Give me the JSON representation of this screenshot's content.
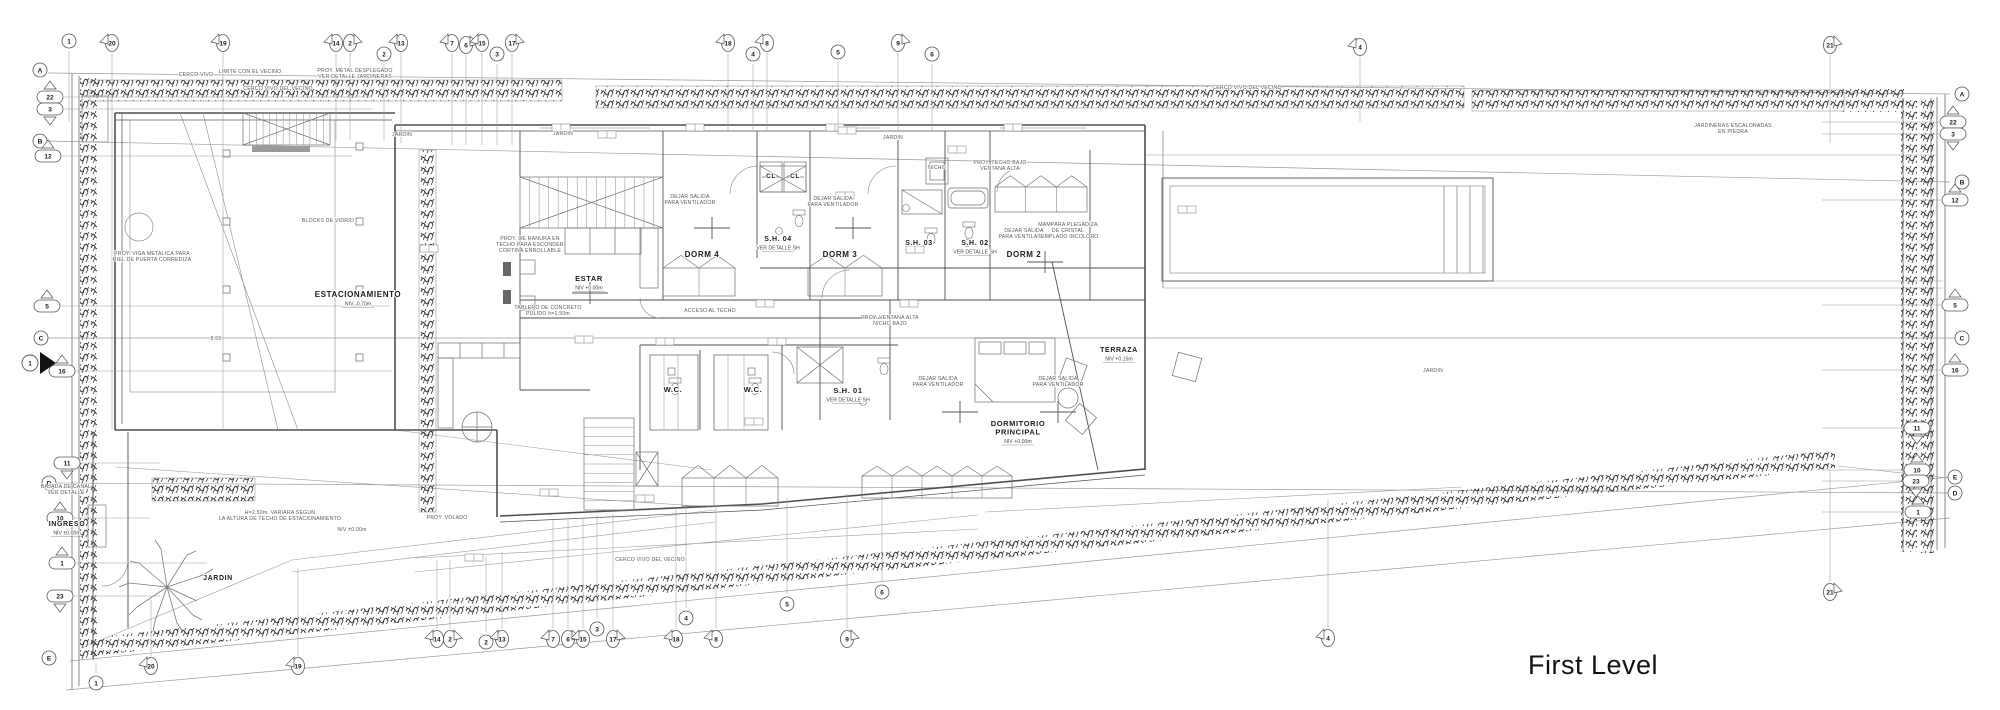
{
  "caption": {
    "text": "First Level"
  },
  "colors": {
    "line": "#9a9a9a",
    "wall": "#4f4f4f",
    "bubble_stroke": "#555555",
    "text": "#1c1c1c",
    "note": "#5a5a5a",
    "vegetation": "#333333",
    "background": "#ffffff"
  },
  "grid": {
    "top": [
      {
        "label": "1",
        "x": 69,
        "y": 41,
        "shape": "circle",
        "lead": 122
      },
      {
        "label": "20",
        "x": 112,
        "y": 43,
        "shape": "flag-left",
        "lead": 430
      },
      {
        "label": "19",
        "x": 223,
        "y": 43,
        "shape": "flag-left",
        "lead": 430
      },
      {
        "label": "14",
        "x": 336,
        "y": 43,
        "shape": "flag-left",
        "lead": 140
      },
      {
        "label": "2",
        "x": 350,
        "y": 43,
        "shape": "flag-right",
        "lead": 140
      },
      {
        "label": "2",
        "x": 384,
        "y": 54,
        "shape": "circle",
        "lead": 140
      },
      {
        "label": "13",
        "x": 401,
        "y": 43,
        "shape": "flag-left",
        "lead": 143
      },
      {
        "label": "7",
        "x": 452,
        "y": 43,
        "shape": "flag-left",
        "lead": 145
      },
      {
        "label": "6",
        "x": 466,
        "y": 45,
        "shape": "flag-right",
        "lead": 145
      },
      {
        "label": "15",
        "x": 482,
        "y": 43,
        "shape": "flag-left",
        "lead": 145
      },
      {
        "label": "3",
        "x": 497,
        "y": 54,
        "shape": "circle",
        "lead": 145
      },
      {
        "label": "17",
        "x": 512,
        "y": 43,
        "shape": "flag-right",
        "lead": 145
      },
      {
        "label": "18",
        "x": 728,
        "y": 43,
        "shape": "flag-left",
        "lead": 131
      },
      {
        "label": "4",
        "x": 753,
        "y": 54,
        "shape": "circle",
        "lead": 131
      },
      {
        "label": "8",
        "x": 767,
        "y": 43,
        "shape": "flag-left",
        "lead": 131
      },
      {
        "label": "5",
        "x": 838,
        "y": 52,
        "shape": "circle",
        "lead": 131
      },
      {
        "label": "9",
        "x": 898,
        "y": 43,
        "shape": "flag-right",
        "lead": 131
      },
      {
        "label": "6",
        "x": 932,
        "y": 54,
        "shape": "circle",
        "lead": 131
      },
      {
        "label": "4",
        "x": 1360,
        "y": 47,
        "shape": "flag-left",
        "lead": 122
      },
      {
        "label": "21",
        "x": 1830,
        "y": 45,
        "shape": "flag-right",
        "lead": 143
      }
    ],
    "bottom": [
      {
        "label": "1",
        "x": 96,
        "y": 683,
        "shape": "circle",
        "lead": 663
      },
      {
        "label": "20",
        "x": 151,
        "y": 666,
        "shape": "flag-left",
        "lead": 600
      },
      {
        "label": "19",
        "x": 298,
        "y": 666,
        "shape": "flag-left",
        "lead": 568
      },
      {
        "label": "14",
        "x": 437,
        "y": 639,
        "shape": "flag-left",
        "lead": 560
      },
      {
        "label": "2",
        "x": 450,
        "y": 639,
        "shape": "flag-right",
        "lead": 560
      },
      {
        "label": "2",
        "x": 486,
        "y": 642,
        "shape": "circle",
        "lead": 556
      },
      {
        "label": "13",
        "x": 502,
        "y": 639,
        "shape": "flag-left",
        "lead": 552
      },
      {
        "label": "7",
        "x": 553,
        "y": 639,
        "shape": "flag-left",
        "lead": 520
      },
      {
        "label": "6",
        "x": 568,
        "y": 639,
        "shape": "flag-right",
        "lead": 520
      },
      {
        "label": "15",
        "x": 583,
        "y": 639,
        "shape": "flag-left",
        "lead": 518
      },
      {
        "label": "3",
        "x": 597,
        "y": 629,
        "shape": "circle",
        "lead": 515
      },
      {
        "label": "17",
        "x": 613,
        "y": 639,
        "shape": "flag-right",
        "lead": 514
      },
      {
        "label": "18",
        "x": 676,
        "y": 639,
        "shape": "flag-left",
        "lead": 508
      },
      {
        "label": "4",
        "x": 686,
        "y": 618,
        "shape": "circle",
        "lead": 506
      },
      {
        "label": "8",
        "x": 716,
        "y": 639,
        "shape": "flag-left",
        "lead": 505
      },
      {
        "label": "5",
        "x": 787,
        "y": 604,
        "shape": "circle",
        "lead": 498
      },
      {
        "label": "9",
        "x": 847,
        "y": 639,
        "shape": "flag-right",
        "lead": 494
      },
      {
        "label": "6",
        "x": 882,
        "y": 592,
        "shape": "circle",
        "lead": 490
      },
      {
        "label": "4",
        "x": 1328,
        "y": 638,
        "shape": "flag-left",
        "lead": 500
      },
      {
        "label": "21",
        "x": 1830,
        "y": 592,
        "shape": "flag-right",
        "lead": 470
      }
    ],
    "left": [
      {
        "label": "A",
        "x": 40,
        "y": 70,
        "shape": "circle"
      },
      {
        "label": "22",
        "x": 50,
        "y": 97,
        "shape": "tri-up",
        "lead": 372
      },
      {
        "label": "3",
        "x": 50,
        "y": 109,
        "shape": "tri-down",
        "lead": 372
      },
      {
        "label": "B",
        "x": 40,
        "y": 141,
        "shape": "circle"
      },
      {
        "label": "12",
        "x": 48,
        "y": 156,
        "shape": "tri-up",
        "lead": 352
      },
      {
        "label": "5",
        "x": 47,
        "y": 306,
        "shape": "tri-up",
        "lead": 390
      },
      {
        "label": "C",
        "x": 41,
        "y": 338,
        "shape": "circle"
      },
      {
        "label": "1",
        "x": 30,
        "y": 363,
        "shape": "entry"
      },
      {
        "label": "16",
        "x": 62,
        "y": 371,
        "shape": "tri-up",
        "lead": 392
      },
      {
        "label": "11",
        "x": 67,
        "y": 463,
        "shape": "tri-down",
        "lead": 160
      },
      {
        "label": "D",
        "x": 49,
        "y": 483,
        "shape": "circle"
      },
      {
        "label": "10",
        "x": 60,
        "y": 518,
        "shape": "tri-up",
        "lead": 150
      },
      {
        "label": "1",
        "x": 62,
        "y": 563,
        "shape": "tri-up",
        "lead": 207
      },
      {
        "label": "23",
        "x": 60,
        "y": 596,
        "shape": "tri-down",
        "lead": 160
      },
      {
        "label": "E",
        "x": 49,
        "y": 658,
        "shape": "circle"
      }
    ],
    "right": [
      {
        "label": "A",
        "x": 1962,
        "y": 94,
        "shape": "circle"
      },
      {
        "label": "22",
        "x": 1953,
        "y": 122,
        "shape": "tri-up",
        "lead": 1822
      },
      {
        "label": "3",
        "x": 1953,
        "y": 134,
        "shape": "tri-down",
        "lead": 1822
      },
      {
        "label": "B",
        "x": 1962,
        "y": 182,
        "shape": "circle"
      },
      {
        "label": "12",
        "x": 1955,
        "y": 200,
        "shape": "tri-up",
        "lead": 1822
      },
      {
        "label": "5",
        "x": 1955,
        "y": 305,
        "shape": "tri-up",
        "lead": 1822
      },
      {
        "label": "C",
        "x": 1962,
        "y": 338,
        "shape": "circle"
      },
      {
        "label": "16",
        "x": 1955,
        "y": 370,
        "shape": "tri-up",
        "lead": 1822
      },
      {
        "label": "11",
        "x": 1917,
        "y": 428,
        "shape": "tri-down",
        "lead": 1822
      },
      {
        "label": "10",
        "x": 1917,
        "y": 470,
        "shape": "tri-up",
        "lead": 1822
      },
      {
        "label": "23",
        "x": 1916,
        "y": 481,
        "shape": "tri-down",
        "lead": 1822
      },
      {
        "label": "E",
        "x": 1955,
        "y": 477,
        "shape": "circle"
      },
      {
        "label": "D",
        "x": 1955,
        "y": 493,
        "shape": "circle"
      },
      {
        "label": "1",
        "x": 1918,
        "y": 512,
        "shape": "tri-up",
        "lead": 1822
      }
    ]
  },
  "rooms": [
    {
      "name": "ESTACIONAMIENTO",
      "x": 358,
      "y": 297,
      "sub": "NIV   -0.70m",
      "fs": 8
    },
    {
      "name": "ESTAR",
      "x": 589,
      "y": 281,
      "sub": "NIV   +0.00m",
      "fs": 7.5
    },
    {
      "name": "DORM 4",
      "x": 702,
      "y": 257,
      "fs": 8
    },
    {
      "name": "DORM 3",
      "x": 840,
      "y": 257,
      "fs": 8
    },
    {
      "name": "DORM 2",
      "x": 1024,
      "y": 257,
      "fs": 8
    },
    {
      "name": "S.H. 04",
      "x": 778,
      "y": 241,
      "sub": "VER DETALLE SH",
      "fs": 7
    },
    {
      "name": "S.H. 03",
      "x": 919,
      "y": 245,
      "fs": 7
    },
    {
      "name": "S.H. 02",
      "x": 975,
      "y": 245,
      "sub": "VER DETALLE SH",
      "fs": 7
    },
    {
      "name": "S.H. 01",
      "x": 848,
      "y": 393,
      "sub": "VER DETALLE SH",
      "fs": 7.5
    },
    {
      "name": "W.C.",
      "x": 673,
      "y": 392,
      "fs": 7.5
    },
    {
      "name": "W.C.",
      "x": 753,
      "y": 392,
      "fs": 7.5
    },
    {
      "name": "CL",
      "x": 771,
      "y": 178,
      "fs": 6.5
    },
    {
      "name": "CL",
      "x": 795,
      "y": 178,
      "fs": 6.5
    },
    {
      "name": "TERRAZA",
      "x": 1119,
      "y": 352,
      "sub": "NIV   +0.15m",
      "fs": 7
    },
    {
      "name": "DORMITORIO\nPRINCIPAL",
      "x": 1018,
      "y": 426,
      "sub": "NIV   +0.00m",
      "fs": 7.5
    },
    {
      "name": "INGRESO",
      "x": 67,
      "y": 526,
      "sub": "NIV   ±0.00m",
      "fs": 7
    },
    {
      "name": "JARDIN",
      "x": 218,
      "y": 580,
      "fs": 7
    }
  ],
  "notes": [
    {
      "text": "CERCO VIVO",
      "x": 196,
      "y": 76
    },
    {
      "text": "LIMITE CON EL VECINO",
      "x": 250,
      "y": 73
    },
    {
      "text": "CERCO VIVO DEL VECINO",
      "x": 278,
      "y": 90
    },
    {
      "text": "PROY. METAL DESPLEGADO\nVER DETALLE JARDINERAS",
      "x": 355,
      "y": 72
    },
    {
      "text": "CERCO VIVO DEL VECINO",
      "x": 1247,
      "y": 89
    },
    {
      "text": "JARDINERAS ESCALONADAS\nEN PIEDRA",
      "x": 1733,
      "y": 127
    },
    {
      "text": "CERCO VIVO DEL VECINO",
      "x": 650,
      "y": 561
    },
    {
      "text": "BLOCKS DE VIDRIO",
      "x": 328,
      "y": 222
    },
    {
      "text": "PROY. VIGA METALICA PARA\nRIEL DE PUERTA CORREDIZA",
      "x": 152,
      "y": 255
    },
    {
      "text": "H=2.50m. VARIARA SEGUN\nLA ALTURA DE TECHO DE ESTACIONAMIENTO",
      "x": 280,
      "y": 514
    },
    {
      "text": "PROY. VOLADO",
      "x": 447,
      "y": 519
    },
    {
      "text": "DEJAR SALIDA\nPARA VENTILADOR",
      "x": 690,
      "y": 198
    },
    {
      "text": "DEJAR SALIDA\nPARA VENTILADOR",
      "x": 833,
      "y": 200
    },
    {
      "text": "DEJAR SALIDA\nPARA VENTILADOR",
      "x": 1024,
      "y": 232
    },
    {
      "text": "DEJAR SALIDA\nPARA VENTILADOR",
      "x": 938,
      "y": 380
    },
    {
      "text": "DEJAR SALIDA\nPARA VENTILADOR",
      "x": 1058,
      "y": 380
    },
    {
      "text": "MAMPARA PLEGADIZA\nDE CRISTAL\nTEMPLADO INCOLORO",
      "x": 1068,
      "y": 226
    },
    {
      "text": "PROY. TECHO BAJO\nVENTANA ALTA",
      "x": 1000,
      "y": 164
    },
    {
      "text": "NICHO",
      "x": 937,
      "y": 169
    },
    {
      "text": "PROY. VENTANA ALTA\nNICHO BAJO",
      "x": 890,
      "y": 319
    },
    {
      "text": "ACCESO AL TECHO",
      "x": 710,
      "y": 312
    },
    {
      "text": "TABLERO DE CONCRETO\nPULIDO h=1.50m",
      "x": 548,
      "y": 309
    },
    {
      "text": "PROY. DE RANURA EN\nTECHO PARA ESCONDER\nCORTINA ENROLLABLE",
      "x": 530,
      "y": 240
    },
    {
      "text": "BAJADA DE CANAL\nVER DETALLE",
      "x": 66,
      "y": 488
    },
    {
      "text": "NIV   ±0.00m",
      "x": 352,
      "y": 531
    },
    {
      "text": "8.55",
      "x": 216,
      "y": 340
    },
    {
      "text": "JARDIN",
      "x": 402,
      "y": 136
    },
    {
      "text": "JARDIN",
      "x": 563,
      "y": 135
    },
    {
      "text": "JARDIN",
      "x": 893,
      "y": 139
    },
    {
      "text": "JARDIN",
      "x": 1433,
      "y": 372
    }
  ]
}
